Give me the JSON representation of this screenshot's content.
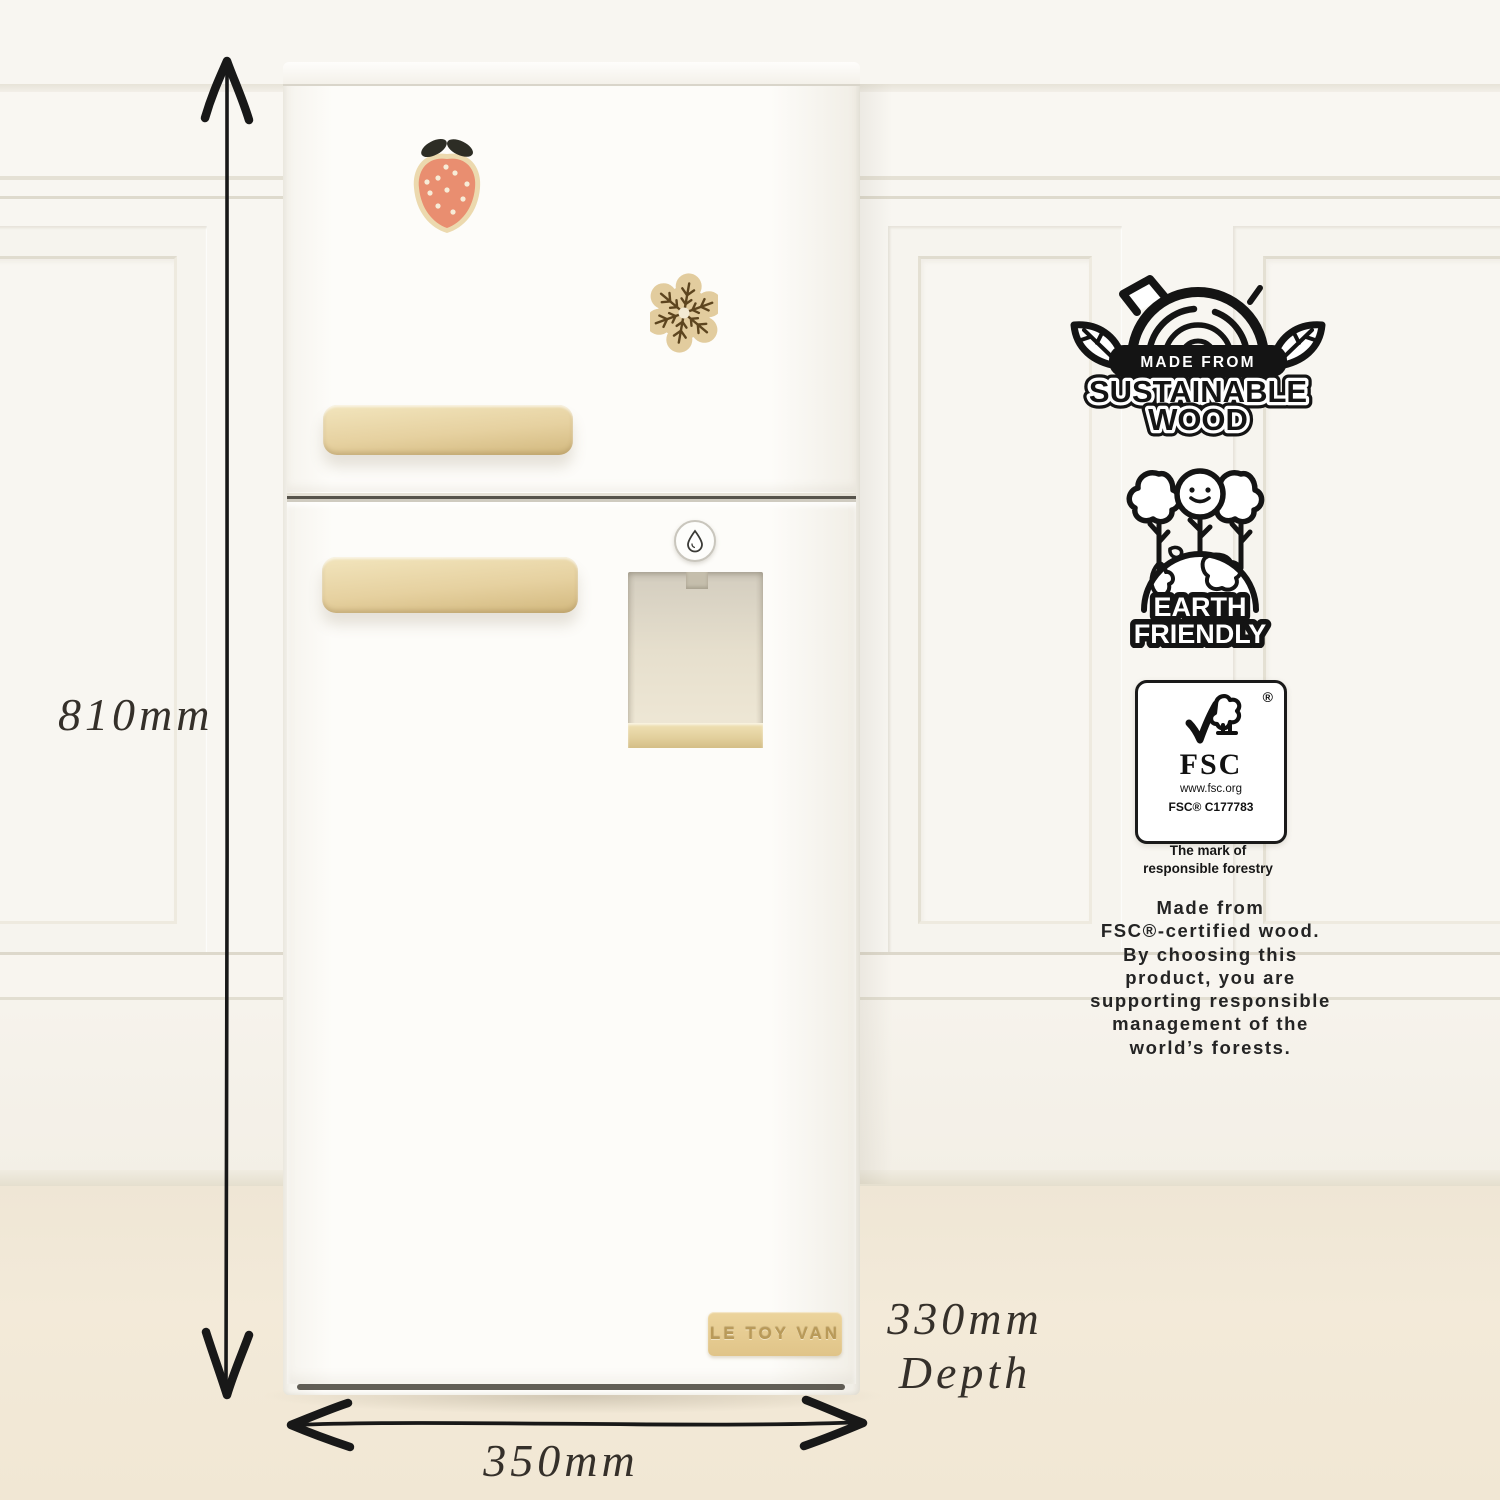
{
  "dimensions": {
    "height": "810mm",
    "width": "350mm",
    "depth_value": "330mm",
    "depth_caption": "Depth"
  },
  "fridge": {
    "brand": "LE TOY VAN"
  },
  "badges": {
    "sustainable_wood": {
      "line1": "MADE FROM",
      "line2": "SUSTAINABLE",
      "line3": "WOOD"
    },
    "earth_friendly": {
      "line1": "EARTH",
      "line2": "FRIENDLY"
    },
    "fsc": {
      "registered_mark": "®",
      "name": "FSC",
      "url": "www.fsc.org",
      "license": "FSC® C177783",
      "tagline_line1": "The mark of",
      "tagline_line2": "responsible forestry"
    },
    "paragraph_lines": [
      "Made from",
      "FSC®-certified wood.",
      "By choosing this",
      "product, you are",
      "supporting responsible",
      "management of the",
      "world’s forests."
    ]
  },
  "icons": {
    "sustainable_wood_badge": "log-with-leaves",
    "earth_friendly_badge": "globe-with-trees",
    "fsc_logo": "checkmark-tree",
    "water_droplet": "droplet",
    "strawberry_magnet": "strawberry",
    "snowflake_magnet": "snowflake",
    "height_arrow": "double-headed-vertical-arrow",
    "width_arrow": "double-headed-horizontal-arrow"
  },
  "colors": {
    "wall": "#f8f6f1",
    "floor": "#f1e7d4",
    "fridge_white": "#fdfcf9",
    "wood": "#e6d1a0",
    "ink_black": "#141414",
    "strawberry": "#e98e70"
  }
}
